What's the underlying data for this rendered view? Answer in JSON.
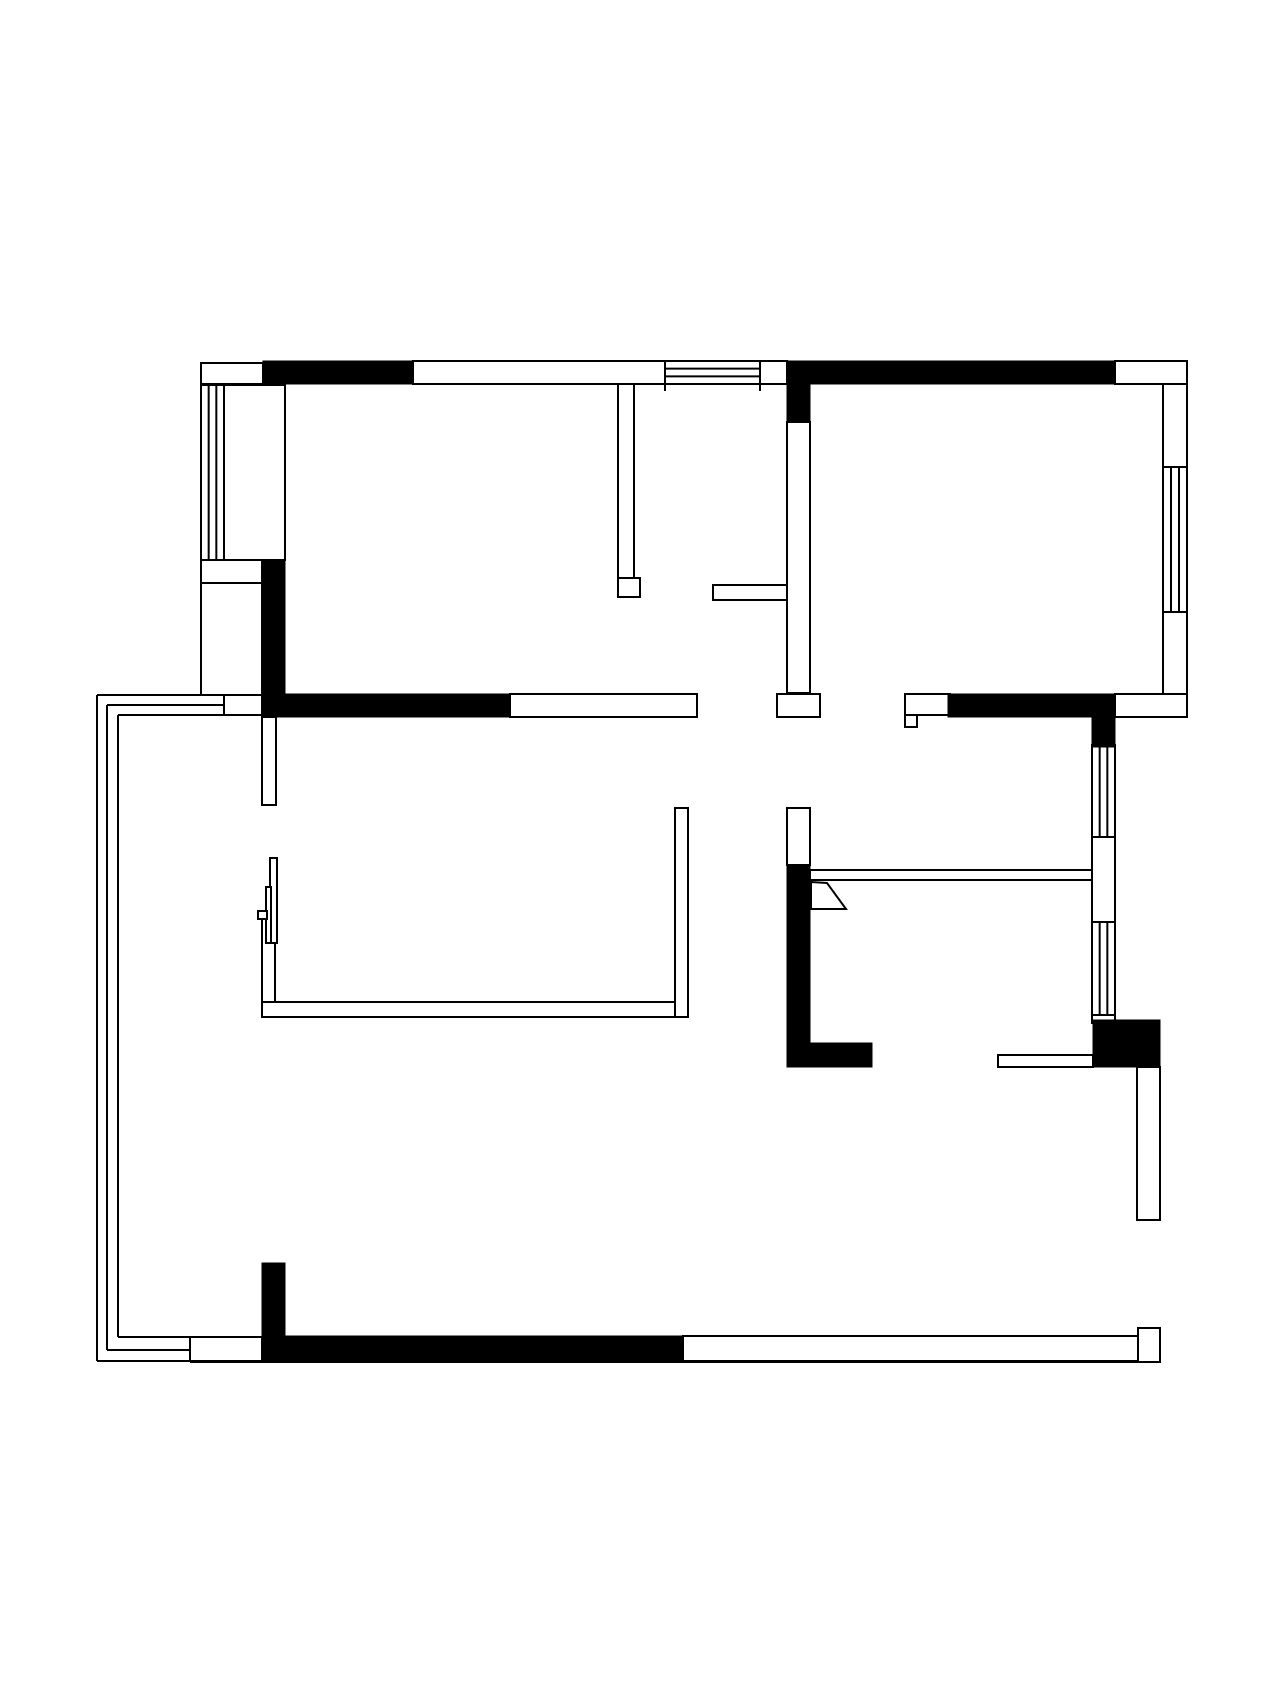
{
  "page": {
    "background": "#ffffff"
  },
  "floorplan": {
    "canvas": {
      "width": 1280,
      "height": 1707
    },
    "colors": {
      "wall_solid": "#000000",
      "outline": "#000000",
      "fill": "#ffffff"
    },
    "stroke_width": 2,
    "solid_walls": [
      {
        "x": 263,
        "y": 361,
        "w": 150,
        "h": 23
      },
      {
        "x": 787,
        "y": 361,
        "w": 328,
        "h": 23
      },
      {
        "x": 787,
        "y": 384,
        "w": 23,
        "h": 38
      },
      {
        "x": 262,
        "y": 560,
        "w": 23,
        "h": 157
      },
      {
        "x": 262,
        "y": 694,
        "w": 248,
        "h": 23
      },
      {
        "x": 948,
        "y": 694,
        "w": 167,
        "h": 23
      },
      {
        "x": 1092,
        "y": 717,
        "w": 23,
        "h": 30
      },
      {
        "x": 787,
        "y": 865,
        "w": 23,
        "h": 202
      },
      {
        "x": 810,
        "y": 1043,
        "w": 62,
        "h": 24
      },
      {
        "x": 1093,
        "y": 1020,
        "w": 67,
        "h": 47
      },
      {
        "x": 262,
        "y": 1336,
        "w": 421,
        "h": 25
      },
      {
        "x": 262,
        "y": 1263,
        "w": 23,
        "h": 73
      }
    ],
    "wall_segments": [
      {
        "x": 201,
        "y": 363,
        "w": 62,
        "h": 21
      },
      {
        "x": 413,
        "y": 361,
        "w": 252,
        "h": 23
      },
      {
        "x": 760,
        "y": 361,
        "w": 27,
        "h": 23
      },
      {
        "x": 1115,
        "y": 361,
        "w": 72,
        "h": 23
      },
      {
        "x": 1163,
        "y": 384,
        "w": 24,
        "h": 83
      },
      {
        "x": 1163,
        "y": 612,
        "w": 24,
        "h": 105
      },
      {
        "x": 224,
        "y": 385,
        "w": 61,
        "h": 175
      },
      {
        "x": 201,
        "y": 560,
        "w": 61,
        "h": 23
      },
      {
        "x": 201,
        "y": 583,
        "w": 61,
        "h": 112
      },
      {
        "x": 618,
        "y": 384,
        "w": 16,
        "h": 194
      },
      {
        "x": 618,
        "y": 578,
        "w": 22,
        "h": 19
      },
      {
        "x": 713,
        "y": 585,
        "w": 75,
        "h": 15
      },
      {
        "x": 787,
        "y": 422,
        "w": 23,
        "h": 271
      },
      {
        "x": 777,
        "y": 694,
        "w": 43,
        "h": 23
      },
      {
        "x": 510,
        "y": 694,
        "w": 187,
        "h": 23
      },
      {
        "x": 905,
        "y": 694,
        "w": 45,
        "h": 21
      },
      {
        "x": 905,
        "y": 715,
        "w": 12,
        "h": 12
      },
      {
        "x": 1115,
        "y": 694,
        "w": 72,
        "h": 23
      },
      {
        "x": 1092,
        "y": 837,
        "w": 23,
        "h": 85
      },
      {
        "x": 1092,
        "y": 1015,
        "w": 23,
        "h": 8
      },
      {
        "x": 262,
        "y": 717,
        "w": 14,
        "h": 88
      },
      {
        "x": 787,
        "y": 808,
        "w": 23,
        "h": 57
      },
      {
        "x": 998,
        "y": 1055,
        "w": 95,
        "h": 12
      },
      {
        "x": 1137,
        "y": 1067,
        "w": 23,
        "h": 153
      },
      {
        "x": 683,
        "y": 1336,
        "w": 455,
        "h": 25
      },
      {
        "x": 1138,
        "y": 1328,
        "w": 22,
        "h": 34
      },
      {
        "x": 190,
        "y": 1337,
        "w": 72,
        "h": 24
      },
      {
        "x": 224,
        "y": 695,
        "w": 38,
        "h": 20
      }
    ],
    "windows": [
      {
        "x": 201,
        "y": 385,
        "w": 23,
        "h": 175,
        "dir": "v"
      },
      {
        "x": 665,
        "y": 361,
        "w": 95,
        "h": 23,
        "dir": "h"
      },
      {
        "x": 1163,
        "y": 467,
        "w": 24,
        "h": 145,
        "dir": "v"
      },
      {
        "x": 1092,
        "y": 745,
        "w": 23,
        "h": 92,
        "dir": "v"
      },
      {
        "x": 1092,
        "y": 922,
        "w": 23,
        "h": 93,
        "dir": "v"
      }
    ],
    "partitions": [
      {
        "x": 810,
        "y": 870,
        "w": 282,
        "h": 10
      }
    ],
    "door_leaves": [
      {
        "points": "811,882 827,883 846,909 811,909"
      }
    ],
    "furniture": [
      {
        "x": 262,
        "y": 913,
        "w": 13,
        "h": 104
      },
      {
        "x": 262,
        "y": 1002,
        "w": 426,
        "h": 15
      },
      {
        "x": 675,
        "y": 808,
        "w": 13,
        "h": 209
      },
      {
        "x": 270,
        "y": 858,
        "w": 7,
        "h": 85
      },
      {
        "x": 266,
        "y": 887,
        "w": 5,
        "h": 56
      },
      {
        "x": 258,
        "y": 911,
        "w": 9,
        "h": 8
      }
    ],
    "lines": [
      {
        "x1": 97,
        "y1": 695,
        "x2": 97,
        "y2": 1361
      },
      {
        "x1": 107,
        "y1": 705,
        "x2": 107,
        "y2": 1350
      },
      {
        "x1": 118,
        "y1": 715,
        "x2": 118,
        "y2": 1337
      },
      {
        "x1": 97,
        "y1": 695,
        "x2": 224,
        "y2": 695
      },
      {
        "x1": 107,
        "y1": 705,
        "x2": 224,
        "y2": 705
      },
      {
        "x1": 118,
        "y1": 715,
        "x2": 262,
        "y2": 715
      },
      {
        "x1": 118,
        "y1": 1337,
        "x2": 190,
        "y2": 1337
      },
      {
        "x1": 107,
        "y1": 1350,
        "x2": 190,
        "y2": 1350
      },
      {
        "x1": 97,
        "y1": 1361,
        "x2": 190,
        "y2": 1361
      },
      {
        "x1": 190,
        "y1": 1362,
        "x2": 1160,
        "y2": 1362
      },
      {
        "x1": 1160,
        "y1": 1328,
        "x2": 1160,
        "y2": 1362
      },
      {
        "x1": 665,
        "y1": 384,
        "x2": 665,
        "y2": 391
      },
      {
        "x1": 760,
        "y1": 384,
        "x2": 760,
        "y2": 391
      }
    ]
  }
}
